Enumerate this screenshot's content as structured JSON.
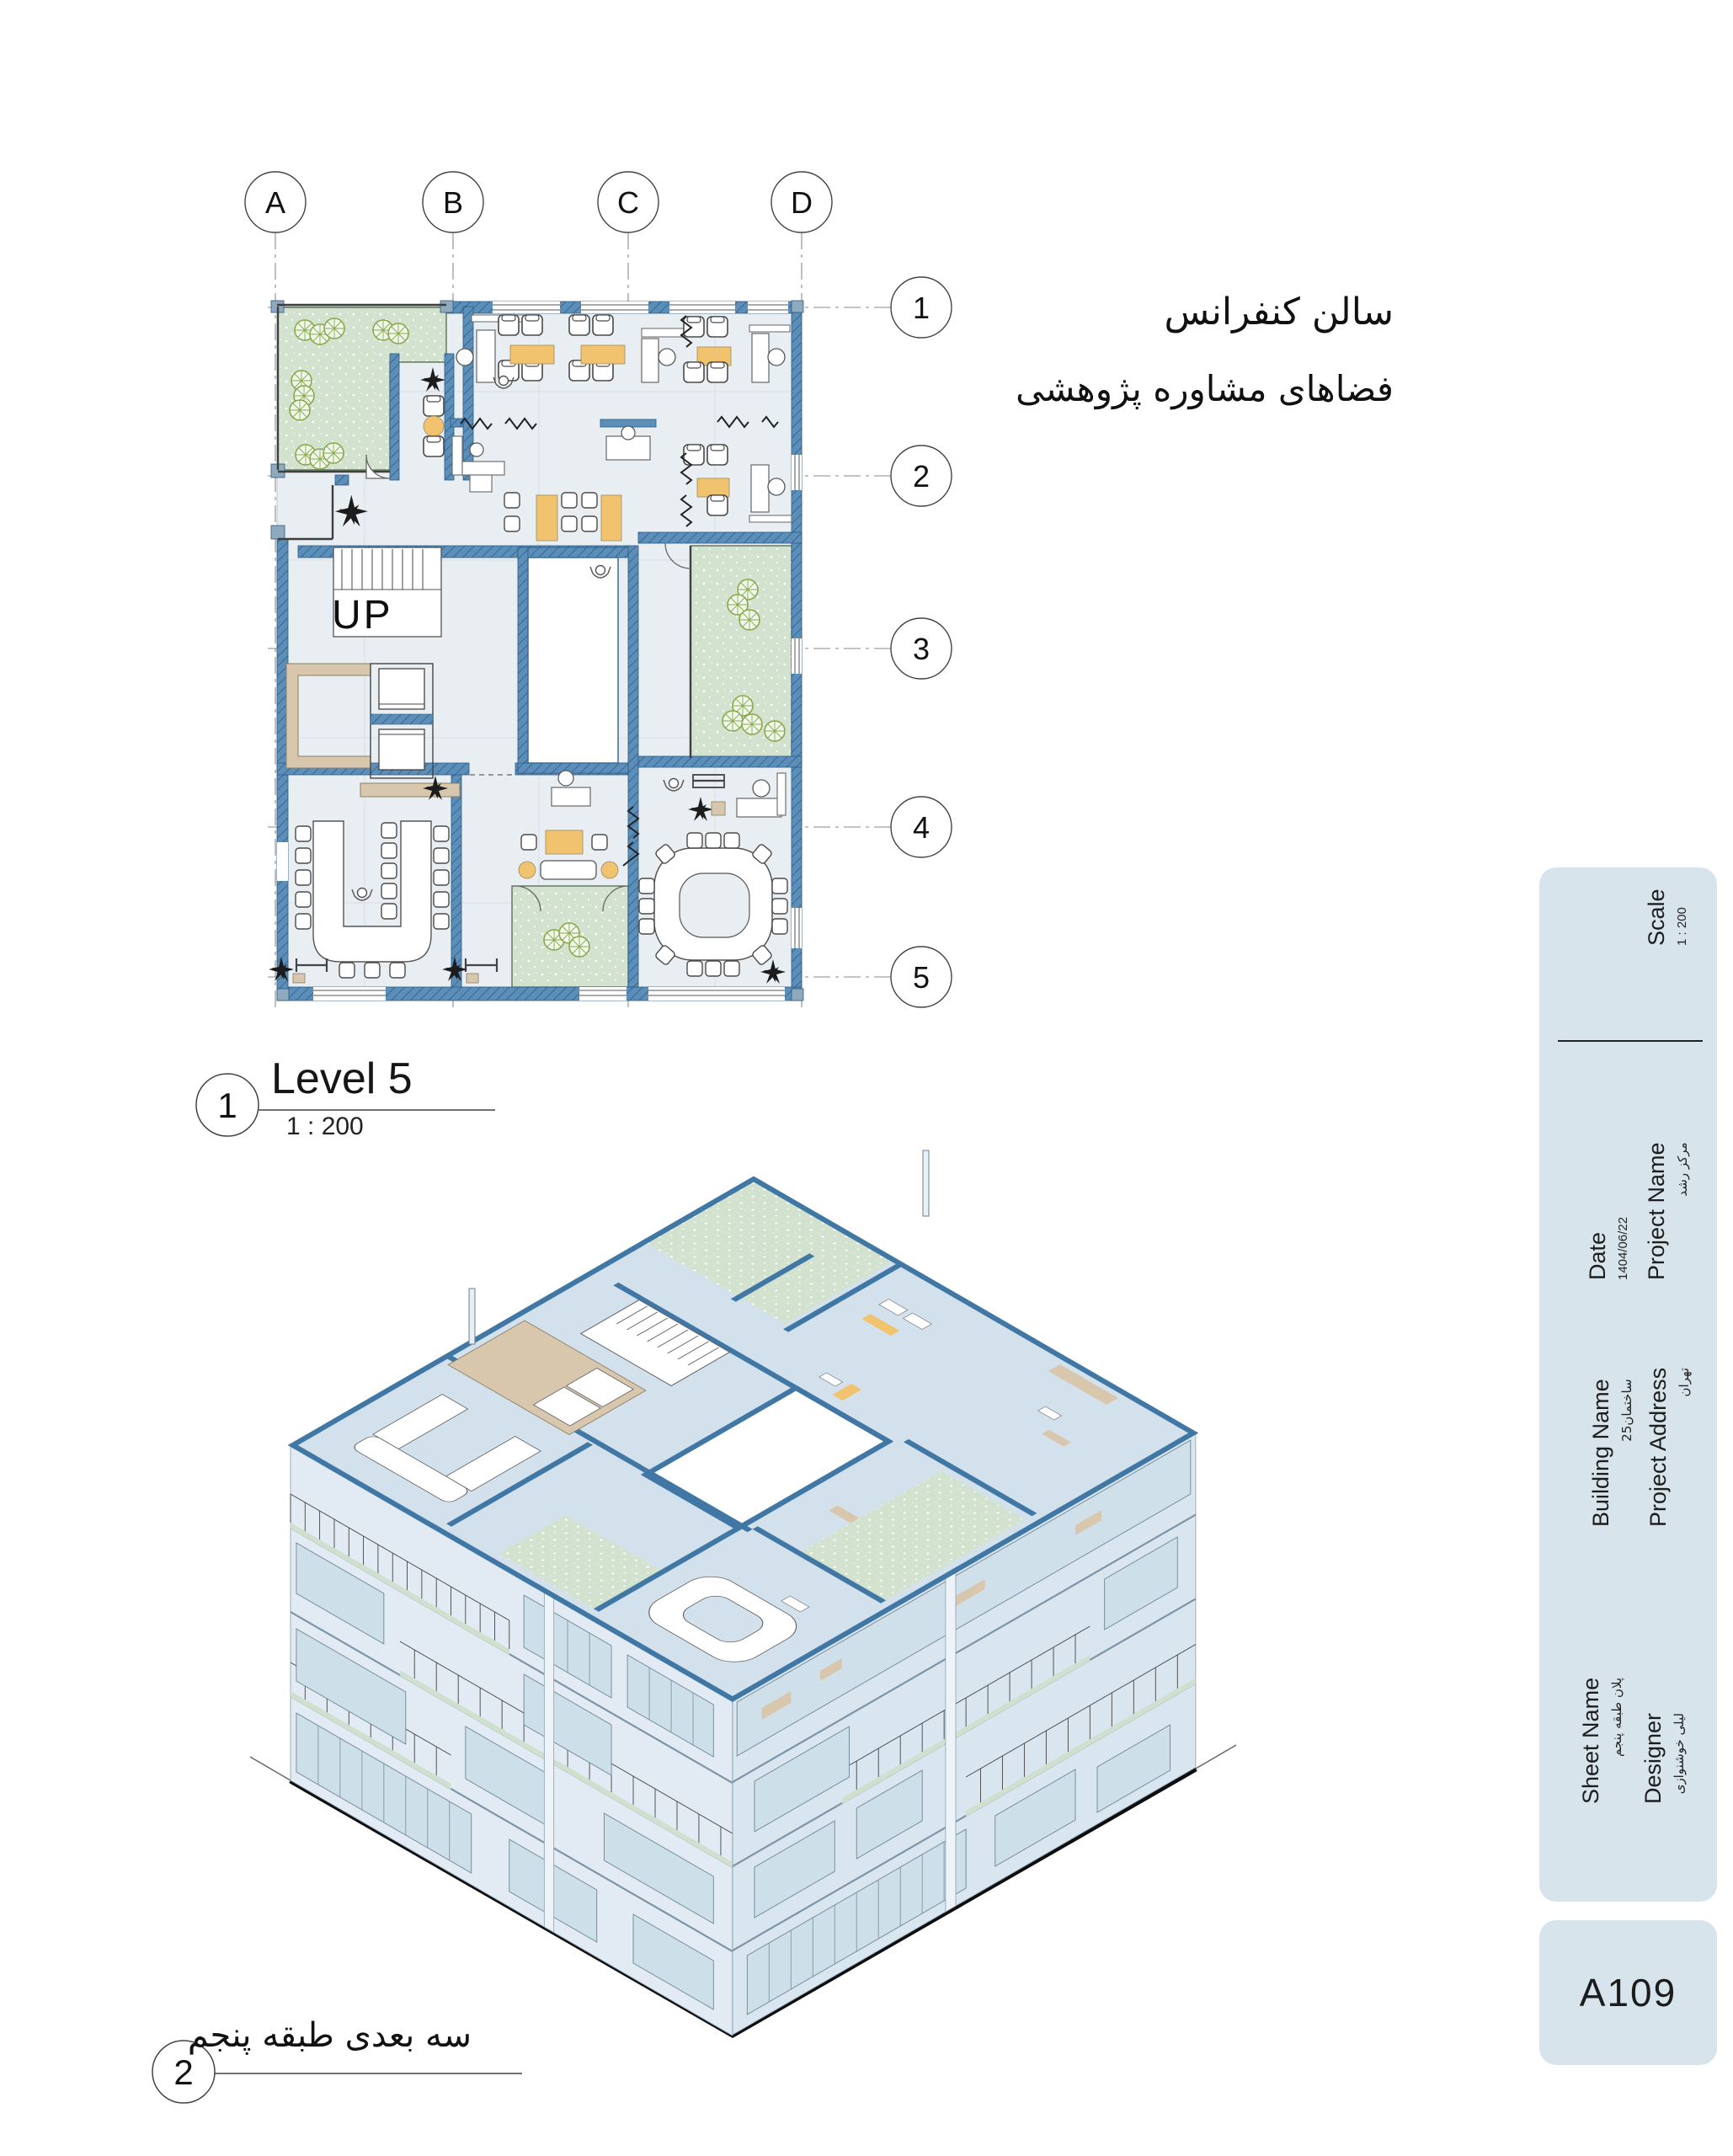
{
  "sheet": {
    "notes": {
      "line1": "سالن کنفرانس",
      "line2": "فضاهای مشاوره پژوهشی"
    },
    "plan_viewport": {
      "number": "1",
      "title": "Level 5",
      "scale": "1 : 200",
      "up_label": "UP"
    },
    "iso_viewport": {
      "number": "2",
      "title": "سه بعدی طبقه پنجم"
    },
    "grid": {
      "columns": [
        "A",
        "B",
        "C",
        "D"
      ],
      "rows": [
        "1",
        "2",
        "3",
        "4",
        "5"
      ]
    },
    "titleblock": {
      "scale": {
        "label": "Scale",
        "value": "1 : 200"
      },
      "date": {
        "label": "Date",
        "value": "1404/06/22"
      },
      "project_name": {
        "label": "Project Name",
        "value": "مرکز رشد"
      },
      "building_name": {
        "label": "Building Name",
        "value": "ساختمان25"
      },
      "project_address": {
        "label": "Project Address",
        "value": "تهران"
      },
      "sheet_name": {
        "label": "Sheet Name",
        "value": "پلان طبقه پنجم"
      },
      "designer": {
        "label": "Designer",
        "value": "لیلی خوشنوازی"
      },
      "sheet_number": "A109"
    },
    "colors": {
      "wall_blue": "#5b8fba",
      "wall_hatch": "#39678f",
      "panel_blue": "#d7e4ec",
      "floor": "#e8eef2",
      "green": "#d2e2cf",
      "orange": "#f2c36f",
      "tan": "#d8c7ad"
    }
  }
}
